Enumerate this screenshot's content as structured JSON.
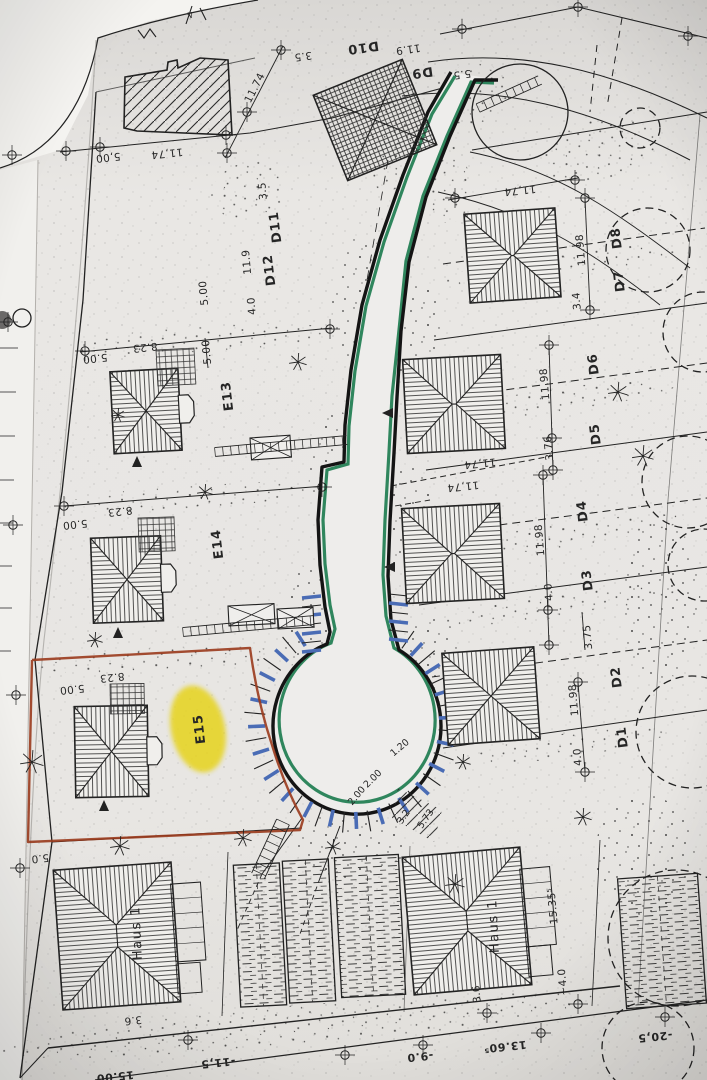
{
  "colors": {
    "paper": "#e7e5e2",
    "ink": "#222222",
    "road_edge_green": "#1a7a4e",
    "parking_blue": "#4a6cb5",
    "boundary_red": "#9a3a1c",
    "highlight_yellow": "#e6d31d"
  },
  "highlight": {
    "plot": "E15",
    "color": "#e6d31d"
  },
  "labels": {
    "plots": [
      {
        "t": "D10",
        "x": 363,
        "y": 47,
        "r": 172
      },
      {
        "t": "D9",
        "x": 422,
        "y": 72,
        "r": 172
      },
      {
        "t": "D11",
        "x": 276,
        "y": 227,
        "r": -97
      },
      {
        "t": "D12",
        "x": 270,
        "y": 270,
        "r": -97
      },
      {
        "t": "D8",
        "x": 617,
        "y": 238,
        "r": -97
      },
      {
        "t": "D7",
        "x": 620,
        "y": 281,
        "r": -97
      },
      {
        "t": "D6",
        "x": 594,
        "y": 364,
        "r": -97
      },
      {
        "t": "D5",
        "x": 596,
        "y": 434,
        "r": -97
      },
      {
        "t": "D4",
        "x": 583,
        "y": 511,
        "r": -97
      },
      {
        "t": "D3",
        "x": 588,
        "y": 580,
        "r": -97
      },
      {
        "t": "D2",
        "x": 617,
        "y": 677,
        "r": -97
      },
      {
        "t": "D1",
        "x": 623,
        "y": 737,
        "r": -97
      },
      {
        "t": "E13",
        "x": 228,
        "y": 396,
        "r": -97
      },
      {
        "t": "E14",
        "x": 218,
        "y": 544,
        "r": -97
      },
      {
        "t": "E15",
        "x": 200,
        "y": 729,
        "r": -97
      }
    ],
    "houses": [
      {
        "t": "Haus 1",
        "x": 137,
        "y": 933,
        "r": -93
      },
      {
        "t": "Haus 1",
        "x": 494,
        "y": 926,
        "r": -93
      }
    ],
    "dimensions": [
      {
        "t": "11.74",
        "x": 255,
        "y": 88,
        "r": -63
      },
      {
        "t": "11,74",
        "x": 167,
        "y": 153,
        "r": 174
      },
      {
        "t": "5,00",
        "x": 108,
        "y": 157,
        "r": 174
      },
      {
        "t": "3.5",
        "x": 303,
        "y": 56,
        "r": 172
      },
      {
        "t": "11.9",
        "x": 408,
        "y": 49,
        "r": 172
      },
      {
        "t": "5.5",
        "x": 462,
        "y": 74,
        "r": 172
      },
      {
        "t": "11,74",
        "x": 520,
        "y": 190,
        "r": 174
      },
      {
        "t": "3.5",
        "x": 263,
        "y": 191,
        "r": -95
      },
      {
        "t": "11.9",
        "x": 247,
        "y": 262,
        "r": -95
      },
      {
        "t": "4.0",
        "x": 252,
        "y": 306,
        "r": -95
      },
      {
        "t": "5.00",
        "x": 204,
        "y": 293,
        "r": -95
      },
      {
        "t": "5.00",
        "x": 207,
        "y": 352,
        "r": -95
      },
      {
        "t": "8.23",
        "x": 145,
        "y": 347,
        "r": 174
      },
      {
        "t": "5.00",
        "x": 95,
        "y": 358,
        "r": 174
      },
      {
        "t": "8.23",
        "x": 120,
        "y": 511,
        "r": 174
      },
      {
        "t": "5.00",
        "x": 75,
        "y": 524,
        "r": 174
      },
      {
        "t": "8.23",
        "x": 112,
        "y": 677,
        "r": 174
      },
      {
        "t": "5.00",
        "x": 72,
        "y": 689,
        "r": 174
      },
      {
        "t": "11.98",
        "x": 581,
        "y": 250,
        "r": -95
      },
      {
        "t": "3.4",
        "x": 577,
        "y": 301,
        "r": -95
      },
      {
        "t": "11.98",
        "x": 545,
        "y": 384,
        "r": -95
      },
      {
        "t": "3.76",
        "x": 549,
        "y": 448,
        "r": -95
      },
      {
        "t": "11.98",
        "x": 540,
        "y": 540,
        "r": -95
      },
      {
        "t": "4.0",
        "x": 549,
        "y": 592,
        "r": -95
      },
      {
        "t": "3.75",
        "x": 588,
        "y": 637,
        "r": -95
      },
      {
        "t": "11.98",
        "x": 574,
        "y": 700,
        "r": -95
      },
      {
        "t": "4.0",
        "x": 578,
        "y": 757,
        "r": -95
      },
      {
        "t": "11,74",
        "x": 480,
        "y": 463,
        "r": 174
      },
      {
        "t": "11,74",
        "x": 463,
        "y": 486,
        "r": 174
      },
      {
        "t": "15.35⁵",
        "x": 553,
        "y": 906,
        "r": -95
      },
      {
        "t": "~4.0",
        "x": 563,
        "y": 982,
        "r": -95
      },
      {
        "t": "3.6",
        "x": 477,
        "y": 994,
        "r": -95
      },
      {
        "t": "3.6",
        "x": 133,
        "y": 1020,
        "r": 174
      },
      {
        "t": "5.0",
        "x": 40,
        "y": 858,
        "r": 174
      }
    ],
    "road_marks": [
      {
        "t": "1.20",
        "x": 400,
        "y": 748,
        "r": -40
      },
      {
        "t": "2.00",
        "x": 373,
        "y": 779,
        "r": -45
      },
      {
        "t": "2.00",
        "x": 357,
        "y": 796,
        "r": -50
      },
      {
        "t": "3.2",
        "x": 404,
        "y": 817,
        "r": -55
      },
      {
        "t": "5.73",
        "x": 426,
        "y": 819,
        "r": -55
      }
    ],
    "elevations": [
      {
        "t": "15.00",
        "x": 115,
        "y": 1076,
        "r": 174
      },
      {
        "t": "-11,5",
        "x": 218,
        "y": 1062,
        "r": 174
      },
      {
        "t": "-9.0",
        "x": 420,
        "y": 1056,
        "r": 174
      },
      {
        "t": "13.60⁵",
        "x": 505,
        "y": 1046,
        "r": 174
      },
      {
        "t": "-20,5",
        "x": 655,
        "y": 1036,
        "r": 174
      }
    ],
    "misc": [
      {
        "t": "4",
        "x": 190,
        "y": 14,
        "r": 150
      }
    ]
  }
}
